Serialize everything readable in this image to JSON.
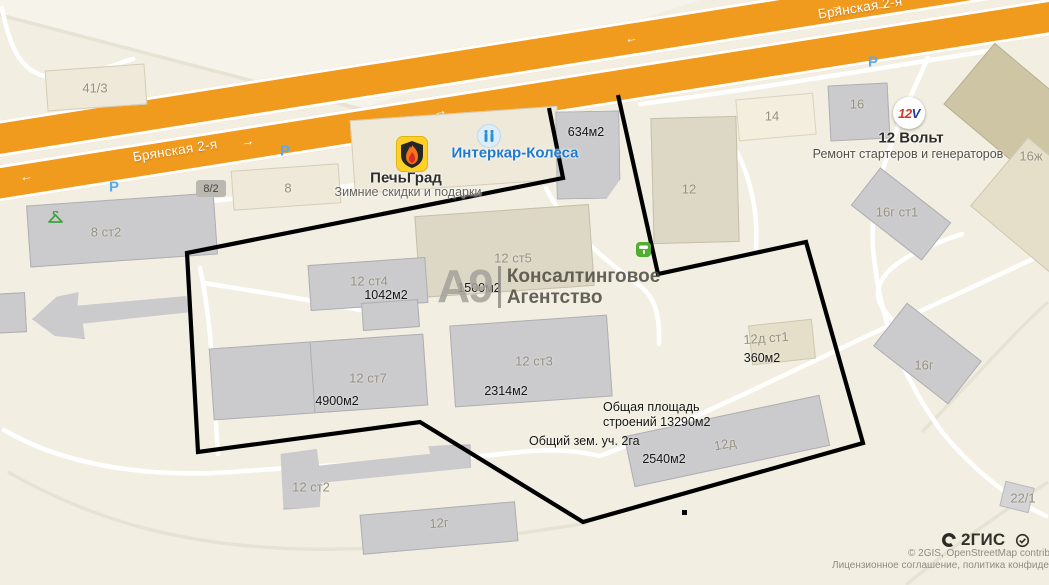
{
  "map": {
    "street_left": "Брянская 2-я",
    "street_right": "Брянская 2-я",
    "parking": "Р",
    "arrow_left": "←",
    "arrow_right": "→"
  },
  "buildings": {
    "b41_3": "41/3",
    "b8_2": "8/2",
    "b8": "8",
    "b8st2": "8 ст2",
    "b12": "12",
    "b14": "14",
    "b16": "16",
    "b16zh": "16ж",
    "b12st5": "12 ст5",
    "b12st4": "12 ст4",
    "b12st7": "12 ст7",
    "b12st3": "12 ст3",
    "b12st2": "12 ст2",
    "b12g": "12г",
    "b12d": "12д",
    "b12dst1": "12д ст1",
    "b16gst1": "16г ст1",
    "b16g": "16г",
    "b22_1": "22/1"
  },
  "areas": {
    "a634": "634м2",
    "a1500": "1500м2",
    "a1042": "1042м2",
    "a4900": "4900м2",
    "a2314": "2314м2",
    "a360": "360м2",
    "a2540": "2540м2",
    "total_buildings_line1": "Общая площадь",
    "total_buildings_line2": "строений 13290м2",
    "total_land": "Общий зем. уч. 2га"
  },
  "businesses": {
    "pechgrad": {
      "name": "ПечьГрад",
      "tagline": "Зимние скидки и подарки"
    },
    "intercar": {
      "name": "Интеркар-Колеса"
    },
    "v12": {
      "logo_12": "12",
      "logo_v": "V",
      "name": "12 Вольт",
      "tagline": "Ремонт стартеров и генераторов"
    },
    "consulting": {
      "logo": "А9",
      "name_line1": "Консалтинговое",
      "name_line2": "Агентство"
    }
  },
  "attribution": {
    "brand": "2ГИС",
    "copyright": "© 2GIS, OpenStreetMap contribut",
    "license": "Лицензионное соглашение, политика конфиденци"
  },
  "colors": {
    "road_orange": "#f09a1e",
    "boundary": "#000000",
    "building_gray": "#cbcbce",
    "building_beige": "#ddd7c6",
    "accent_blue": "#1d7ad2",
    "brand_red": "#d6372b",
    "brand_blue": "#20409a",
    "green_poi": "#3fa43f"
  }
}
